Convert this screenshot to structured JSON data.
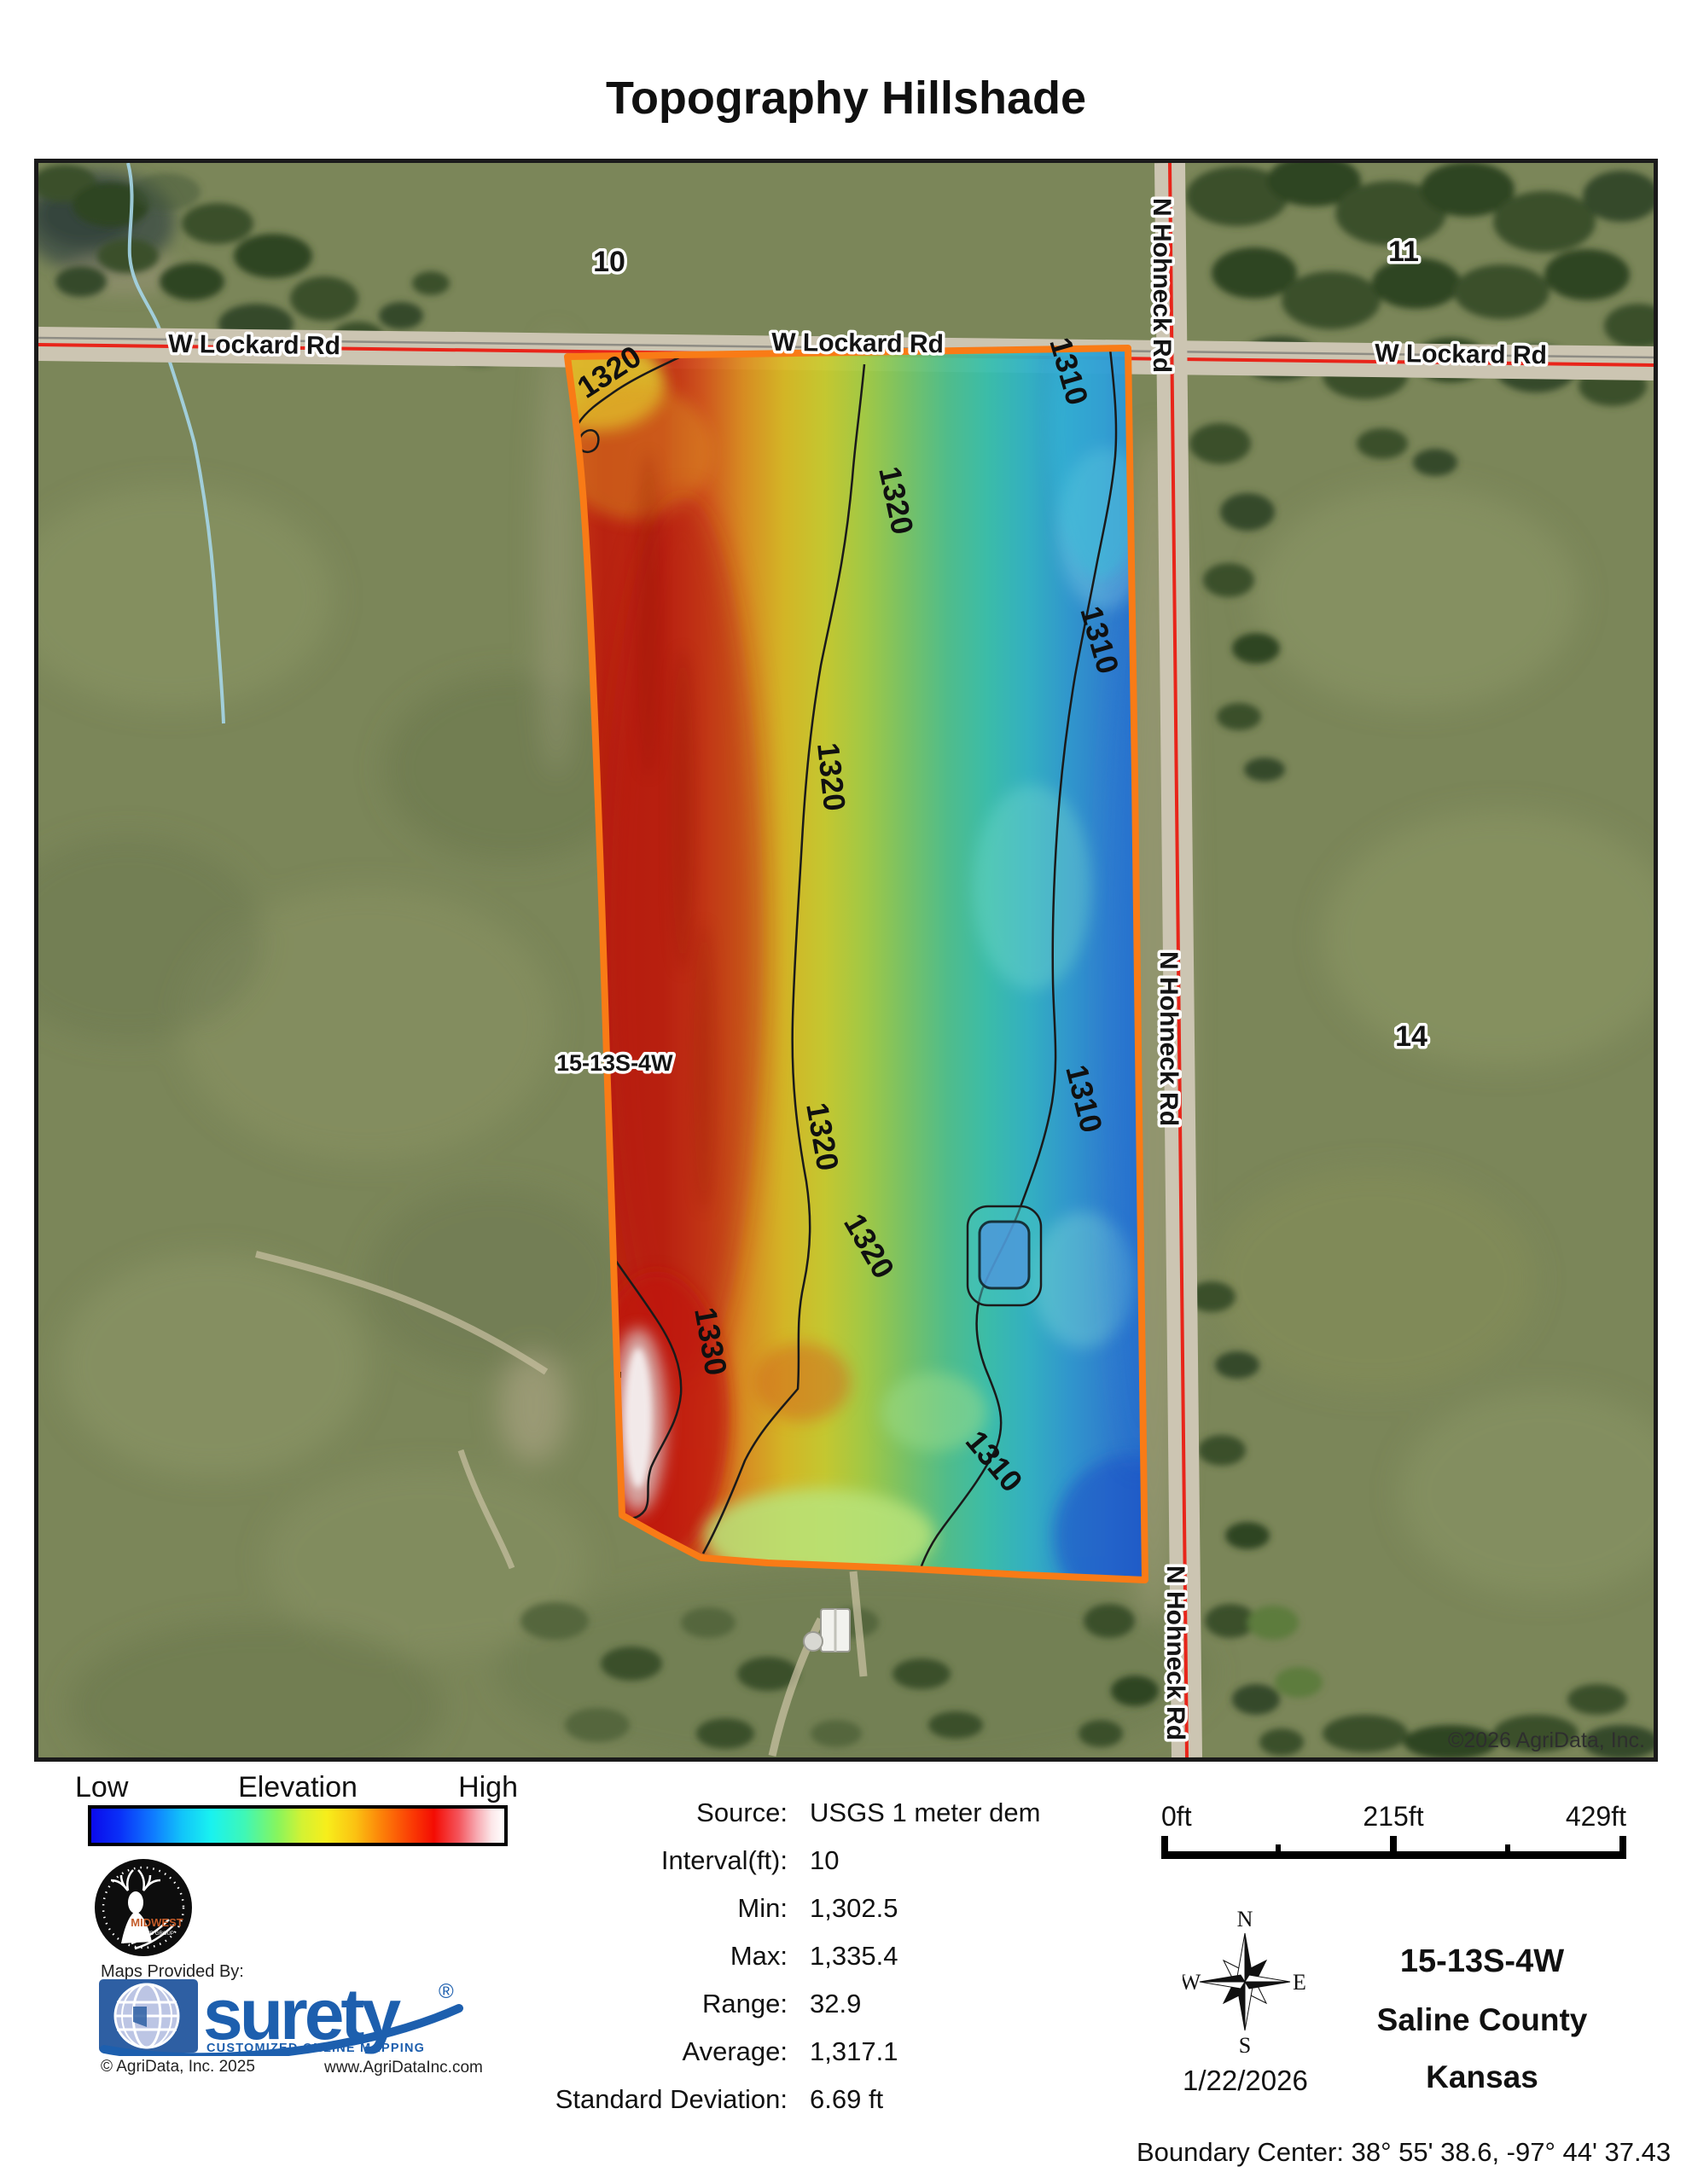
{
  "title": "Topography Hillshade",
  "map": {
    "road_h": "W Lockard Rd",
    "road_v": "N Hohneck Rd",
    "section_10": "10",
    "section_11": "11",
    "section_14": "14",
    "parcel": "15-13S-4W",
    "contour_1310": "1310",
    "contour_1320": "1320",
    "contour_1330": "1330",
    "copyright": "©2026 AgriData, Inc.",
    "boundary_color": "#F97B16",
    "road_line_color": "#E8251A"
  },
  "legend": {
    "low": "Low",
    "title": "Elevation",
    "high": "High",
    "colors": [
      "#0b0beb 0%",
      "#0a31f8 7%",
      "#0f7bff 15%",
      "#12c4fa 22%",
      "#19f2f0 29%",
      "#3ef7b7 37%",
      "#86f55e 45%",
      "#d3f233 51%",
      "#f7ee1b 57%",
      "#fbc112 64%",
      "#fc8409 70%",
      "#fb4105 77%",
      "#f40c03 83%",
      "#f4555c 89%",
      "#f7a3ab 93%",
      "#fce7e9 97%",
      "#ffffff 100%"
    ]
  },
  "stats": {
    "rows": [
      {
        "label": "Source:",
        "value": "USGS 1 meter dem"
      },
      {
        "label": "Interval(ft):",
        "value": "10"
      },
      {
        "label": "Min:",
        "value": "1,302.5"
      },
      {
        "label": "Max:",
        "value": "1,335.4"
      },
      {
        "label": "Range:",
        "value": "32.9"
      },
      {
        "label": "Average:",
        "value": "1,317.1"
      },
      {
        "label": "Standard Deviation:",
        "value": "6.69 ft"
      }
    ]
  },
  "scalebar": {
    "start": "0ft",
    "middle": "215ft",
    "end": "429ft"
  },
  "compass": {
    "north": "N",
    "south": "S",
    "east": "E",
    "west": "W"
  },
  "date": "1/22/2026",
  "location": {
    "trs": "15-13S-4W",
    "county": "Saline County",
    "state": "Kansas"
  },
  "boundary": {
    "label": "Boundary Center:",
    "value": "38° 55' 38.6,  -97° 44' 37.43"
  },
  "branding": {
    "provided_by": "Maps Provided By:",
    "brand": "surety",
    "registered": "®",
    "tagline": "CUSTOMIZED ONLINE MAPPING",
    "copyright": "© AgriData, Inc. 2025",
    "website": "www.AgriDataInc.com",
    "midwest": "MIDWEST",
    "midwest_sub": "LAND GROUP",
    "brand_color": "#1d5fae",
    "midwest_color": "#c35b28"
  }
}
